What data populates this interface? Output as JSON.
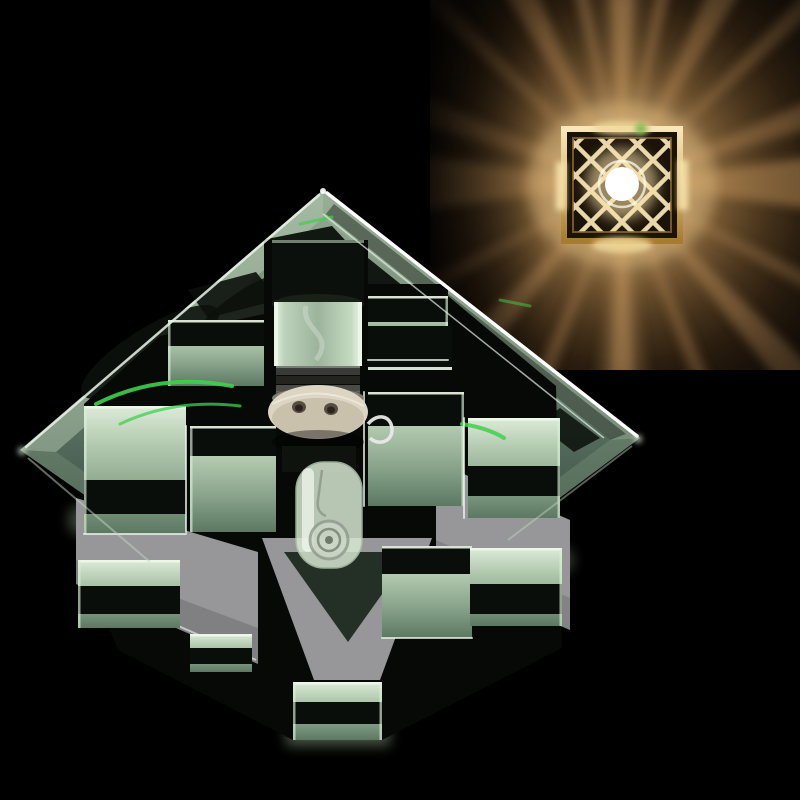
{
  "image": {
    "kind": "product photograph",
    "subject": "crystal glass halogen ceiling spotlight, unlit, mirrored green-tinted glass cubes stacked under a beveled square mirror plate with ceramic lamp socket visible",
    "background": "solid black studio backdrop",
    "inset": "small photo at top right showing the same fixture switched on: warm amber light rays bursting through a gold diamond-lattice shade around a bright bulb"
  },
  "colors": {
    "background": "#000000",
    "ray_amber": "#c9995f",
    "glow_gold": "#f2d49a",
    "lattice_gold": "#f2e2b2",
    "bulb_white": "#ffffff",
    "metal_grey": "#97979a",
    "ceramic_white": "#ddd5c4",
    "accent_green": "#3fd04d",
    "crystal_light": "#d8e9d4",
    "crystal_mid": "#a3bda2",
    "crystal_deep": "#64816a",
    "reflection_black": "#0a0e0a"
  }
}
